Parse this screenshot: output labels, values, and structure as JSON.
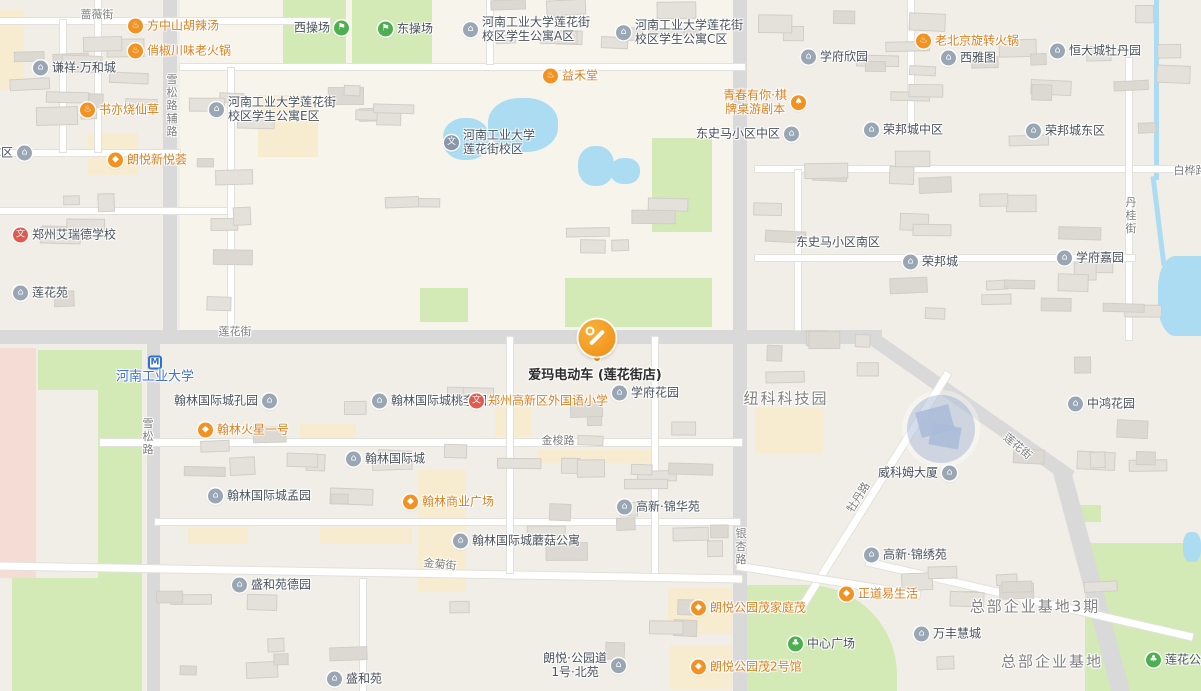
{
  "colors": {
    "orange_poi": "#f29222",
    "gray_poi_icon": "#99a6b4",
    "school_icon": "#e15a50",
    "green_poi": "#4caf50",
    "metro_blue": "#2e6fd0",
    "road_gray": "#d9d9d9",
    "water": "#abdcf2",
    "green_area": "#d3e9b6",
    "highlight_circle": "#b0c1dd"
  },
  "marker": {
    "id": "aima-store",
    "label": "爱玛电动车 (莲花街店)",
    "x": 597,
    "y": 338
  },
  "map": {
    "streets": [
      {
        "id": "qiangweijie",
        "label": "蔷薇街",
        "x": 97,
        "y": 14
      },
      {
        "id": "xuesonglu-north",
        "label": "雪松路辅路",
        "x": 171,
        "y": 106,
        "vertical": true
      },
      {
        "id": "xuesonglu-south",
        "label": "雪松路",
        "x": 147,
        "y": 437,
        "vertical": true
      },
      {
        "id": "lianhuajie-west",
        "label": "莲花街",
        "x": 235,
        "y": 331
      },
      {
        "id": "jinsuolu",
        "label": "金梭路",
        "x": 558,
        "y": 440
      },
      {
        "id": "jinjujie",
        "label": "金菊街",
        "x": 440,
        "y": 564,
        "rot": 6
      },
      {
        "id": "lianhuajie-east",
        "label": "莲花街",
        "x": 1018,
        "y": 446,
        "rot": 40
      },
      {
        "id": "mudanlu",
        "label": "牡丹路",
        "x": 858,
        "y": 497,
        "rot": -58
      },
      {
        "id": "baihualu",
        "label": "白桦路",
        "x": 1190,
        "y": 170
      },
      {
        "id": "danguijie",
        "label": "丹桂街",
        "x": 1130,
        "y": 216,
        "vertical": true
      },
      {
        "id": "yinxinglu",
        "label": "银杏路",
        "x": 740,
        "y": 547,
        "vertical": true
      }
    ],
    "districts": [
      {
        "id": "niuke-tech-park",
        "label": "纽科科技园",
        "x": 786,
        "y": 398
      },
      {
        "id": "hq-base-phase3",
        "label": "总部企业基地3期",
        "x": 1035,
        "y": 606
      },
      {
        "id": "hq-base",
        "label": "总部企业基地",
        "x": 1052,
        "y": 661
      }
    ],
    "pois": [
      {
        "id": "qianxiang-wanhecheng",
        "label": "谦祥·万和城",
        "x": 42,
        "y": 68,
        "type": "res"
      },
      {
        "id": "haut-dorm-e",
        "lines": [
          "河南工业大学莲花街",
          "校区学生公寓E区"
        ],
        "x": 218,
        "y": 110,
        "type": "res"
      },
      {
        "id": "west-playground",
        "label": "西操场",
        "x": 340,
        "y": 28,
        "type": "sport",
        "iconSide": "right"
      },
      {
        "id": "east-playground",
        "label": "东操场",
        "x": 387,
        "y": 29,
        "type": "sport"
      },
      {
        "id": "haut-dorm-a",
        "lines": [
          "河南工业大学莲花街",
          "校区学生公寓A区"
        ],
        "x": 472,
        "y": 30,
        "type": "res"
      },
      {
        "id": "yihetang",
        "label": "益禾堂",
        "x": 552,
        "y": 76,
        "type": "drink",
        "textColor": "orange"
      },
      {
        "id": "haut-lianhua-campus",
        "lines": [
          "河南工业大学",
          "莲花街校区"
        ],
        "x": 453,
        "y": 143,
        "type": "edu"
      },
      {
        "id": "haut-dorm-c",
        "lines": [
          "河南工业大学莲花街",
          "校区学生公寓C区"
        ],
        "x": 625,
        "y": 33,
        "type": "res"
      },
      {
        "id": "xuefu-xinyuan",
        "label": "学府欣园",
        "x": 810,
        "y": 57,
        "type": "res"
      },
      {
        "id": "laobeijing-hotpot",
        "label": "老北京旋转火锅",
        "x": 925,
        "y": 41,
        "type": "food",
        "textColor": "orange"
      },
      {
        "id": "xiyatu",
        "label": "西雅图",
        "x": 950,
        "y": 58,
        "type": "res"
      },
      {
        "id": "hengdacheng-mudanyuan",
        "label": "恒大城牡丹园",
        "x": 1059,
        "y": 51,
        "type": "res"
      },
      {
        "id": "rongbangcheng-zhongqu",
        "label": "荣邦城中区",
        "x": 873,
        "y": 130,
        "type": "res"
      },
      {
        "id": "rongbangcheng-dongqu",
        "label": "荣邦城东区",
        "x": 1035,
        "y": 131,
        "type": "res"
      },
      {
        "id": "qingchun-boardgame",
        "lines": [
          "青春有你·棋",
          "牌桌游剧本"
        ],
        "x": 797,
        "y": 103,
        "type": "ent",
        "iconSide": "right",
        "textColor": "orange"
      },
      {
        "id": "dongshima-zhongqu",
        "label": "东史马小区中区",
        "x": 790,
        "y": 134,
        "type": "res",
        "iconSide": "right"
      },
      {
        "id": "fangzhongshan",
        "label": "方中山胡辣汤",
        "x": 137,
        "y": 26,
        "type": "food",
        "textColor": "orange"
      },
      {
        "id": "qiaojiao-hotpot",
        "label": "俏椒川味老火锅",
        "x": 137,
        "y": 51,
        "type": "food",
        "textColor": "orange"
      },
      {
        "id": "shuyi-shaoxiancao",
        "label": "书亦烧仙草",
        "x": 89,
        "y": 110,
        "type": "drink",
        "textColor": "orange"
      },
      {
        "id": "langyue-xinyuehui",
        "label": "朗悦新悦荟",
        "x": 117,
        "y": 160,
        "type": "shop",
        "textColor": "orange"
      },
      {
        "id": "airuide-school",
        "label": "郑州艾瑞德学校",
        "x": 22,
        "y": 235,
        "type": "school"
      },
      {
        "id": "lianhuayuan",
        "label": "莲花苑",
        "x": 22,
        "y": 293,
        "type": "res"
      },
      {
        "id": "c-block",
        "label": "C区",
        "x": 23,
        "y": 153,
        "type": "res",
        "iconSide": "right"
      },
      {
        "id": "haut-metro-station",
        "label": "河南工业大学",
        "x": 155,
        "y": 372,
        "type": "metro"
      },
      {
        "id": "hanlin-kongyuan",
        "label": "翰林国际城孔园",
        "x": 268,
        "y": 401,
        "type": "res",
        "iconSide": "right"
      },
      {
        "id": "hanlin-huoxing",
        "label": "翰林火星一号",
        "x": 207,
        "y": 430,
        "type": "shop",
        "textColor": "orange"
      },
      {
        "id": "hanlin-taoliyuan",
        "label": "翰林国际城桃李园",
        "x": 381,
        "y": 401,
        "type": "res"
      },
      {
        "id": "waiguoyu-primary",
        "label": "郑州高新区外国语小学",
        "x": 478,
        "y": 401,
        "type": "school",
        "textColor": "orange"
      },
      {
        "id": "xuefu-huayuan",
        "label": "学府花园",
        "x": 621,
        "y": 393,
        "type": "res"
      },
      {
        "id": "hanlin-intl-city",
        "label": "翰林国际城",
        "x": 355,
        "y": 459,
        "type": "res"
      },
      {
        "id": "hanlin-mengyuan",
        "label": "翰林国际城孟园",
        "x": 217,
        "y": 496,
        "type": "res"
      },
      {
        "id": "hanlin-shangye",
        "label": "翰林商业广场",
        "x": 412,
        "y": 502,
        "type": "shop",
        "textColor": "orange"
      },
      {
        "id": "hanlin-mogu-apt",
        "label": "翰林国际城蘑菇公寓",
        "x": 462,
        "y": 541,
        "type": "res"
      },
      {
        "id": "gaoxin-jinhuayuan",
        "label": "高新·锦华苑",
        "x": 626,
        "y": 507,
        "type": "res"
      },
      {
        "id": "shengheyuan-deyuan",
        "label": "盛和苑德园",
        "x": 241,
        "y": 585,
        "type": "res"
      },
      {
        "id": "shengheyuan",
        "label": "盛和苑",
        "x": 336,
        "y": 679,
        "type": "res"
      },
      {
        "id": "langyue-jiating-mall",
        "label": "朗悦公园茂家庭茂",
        "x": 700,
        "y": 608,
        "type": "shop",
        "textColor": "orange"
      },
      {
        "id": "langyue-gongyuandao",
        "lines": [
          "朗悦·公园道",
          "1号·北苑"
        ],
        "x": 617,
        "y": 666,
        "type": "res",
        "iconSide": "right"
      },
      {
        "id": "langyue-mall-2",
        "label": "朗悦公园茂2号馆",
        "x": 700,
        "y": 667,
        "type": "shop",
        "textColor": "orange"
      },
      {
        "id": "zhongxin-guangchang",
        "label": "中心广场",
        "x": 797,
        "y": 644,
        "type": "park"
      },
      {
        "id": "zhengdao-life",
        "label": "正道易生活",
        "x": 848,
        "y": 594,
        "type": "shop",
        "textColor": "orange"
      },
      {
        "id": "gaoxin-jinxiuyuan",
        "label": "高新·锦绣苑",
        "x": 873,
        "y": 555,
        "type": "res"
      },
      {
        "id": "weikemu-tower",
        "label": "威科姆大厦",
        "x": 948,
        "y": 473,
        "type": "office",
        "iconSide": "right"
      },
      {
        "id": "wanfeng-huicheng",
        "label": "万丰慧城",
        "x": 923,
        "y": 634,
        "type": "res"
      },
      {
        "id": "lianhua-gongyuan",
        "label": "莲花公园",
        "x": 1155,
        "y": 660,
        "type": "park"
      },
      {
        "id": "xuefu-jiayuan",
        "label": "学府嘉园",
        "x": 1066,
        "y": 258,
        "type": "res"
      },
      {
        "id": "rongbangcheng",
        "label": "荣邦城",
        "x": 912,
        "y": 262,
        "type": "res"
      },
      {
        "id": "dongshima-nanqu",
        "label": "东史马小区南区",
        "x": 838,
        "y": 243,
        "type": "plain"
      },
      {
        "id": "zhonghong-huayuan",
        "label": "中鸿花园",
        "x": 1077,
        "y": 404,
        "type": "res"
      }
    ]
  }
}
